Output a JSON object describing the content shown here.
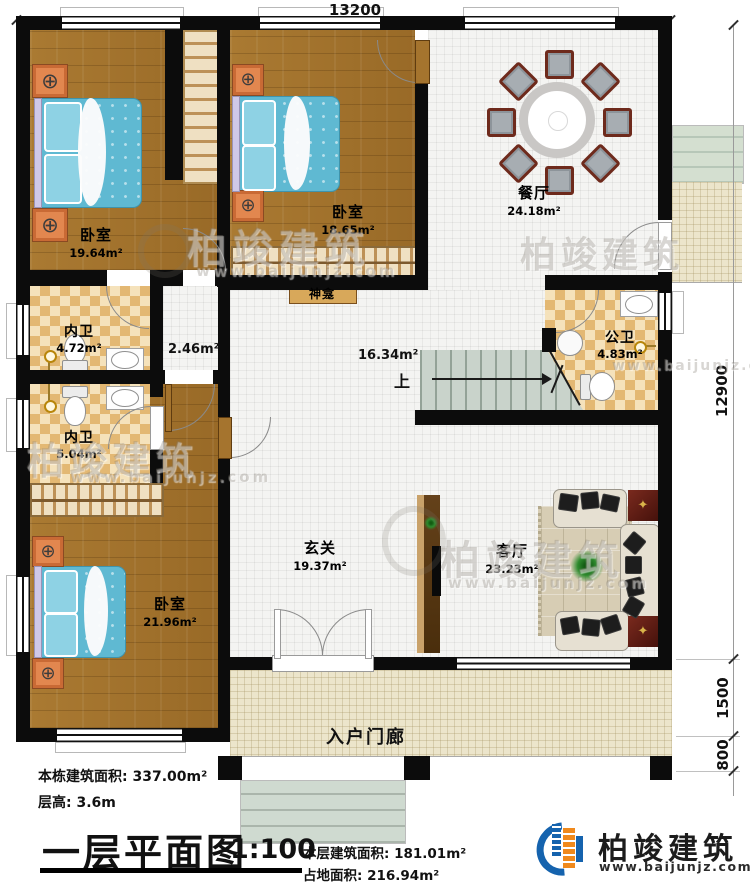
{
  "meta": {
    "plan_title": "一层平面图",
    "scale": "1:100"
  },
  "stats": {
    "building_area_label": "本栋建筑面积:",
    "building_area": "337.00m²",
    "floor_height_label": "层高:",
    "floor_height": "3.6m",
    "floor_area_label": "本层建筑面积:",
    "floor_area": "181.01m²",
    "land_area_label": "占地面积:",
    "land_area": "216.94m²"
  },
  "brand": {
    "name": "柏竣建筑",
    "website": "www.baijunjz.com"
  },
  "watermark": {
    "text": "柏竣建筑",
    "site": "www.baijunjz.com"
  },
  "dimensions": {
    "top": "13200",
    "right": [
      "12900",
      "1500",
      "800"
    ]
  },
  "rooms": [
    {
      "id": "bedroom-1",
      "name": "卧室",
      "area": "19.64m²"
    },
    {
      "id": "bedroom-2",
      "name": "卧室",
      "area": "18.65m²"
    },
    {
      "id": "dining-room",
      "name": "餐厅",
      "area": "24.18m²"
    },
    {
      "id": "ensuite-bath-1",
      "name": "内卫",
      "area": "4.72m²"
    },
    {
      "id": "ensuite-bath-2",
      "name": "内卫",
      "area": "5.04m²"
    },
    {
      "id": "public-bath",
      "name": "公卫",
      "area": "4.83m²"
    },
    {
      "id": "corridor",
      "name": "",
      "area": "2.46m²"
    },
    {
      "id": "hall",
      "name": "",
      "area": "16.34m²"
    },
    {
      "id": "foyer",
      "name": "玄关",
      "area": "19.37m²"
    },
    {
      "id": "living-room",
      "name": "客厅",
      "area": "23.23m²"
    },
    {
      "id": "bedroom-3",
      "name": "卧室",
      "area": "21.96m²"
    },
    {
      "id": "entry-porch",
      "name": "入户门廊",
      "area": ""
    },
    {
      "id": "shrine",
      "name": "神龛",
      "area": ""
    },
    {
      "id": "stairs",
      "name": "上",
      "area": ""
    }
  ],
  "icons": {
    "lamp": "⊕",
    "star": "✦"
  }
}
